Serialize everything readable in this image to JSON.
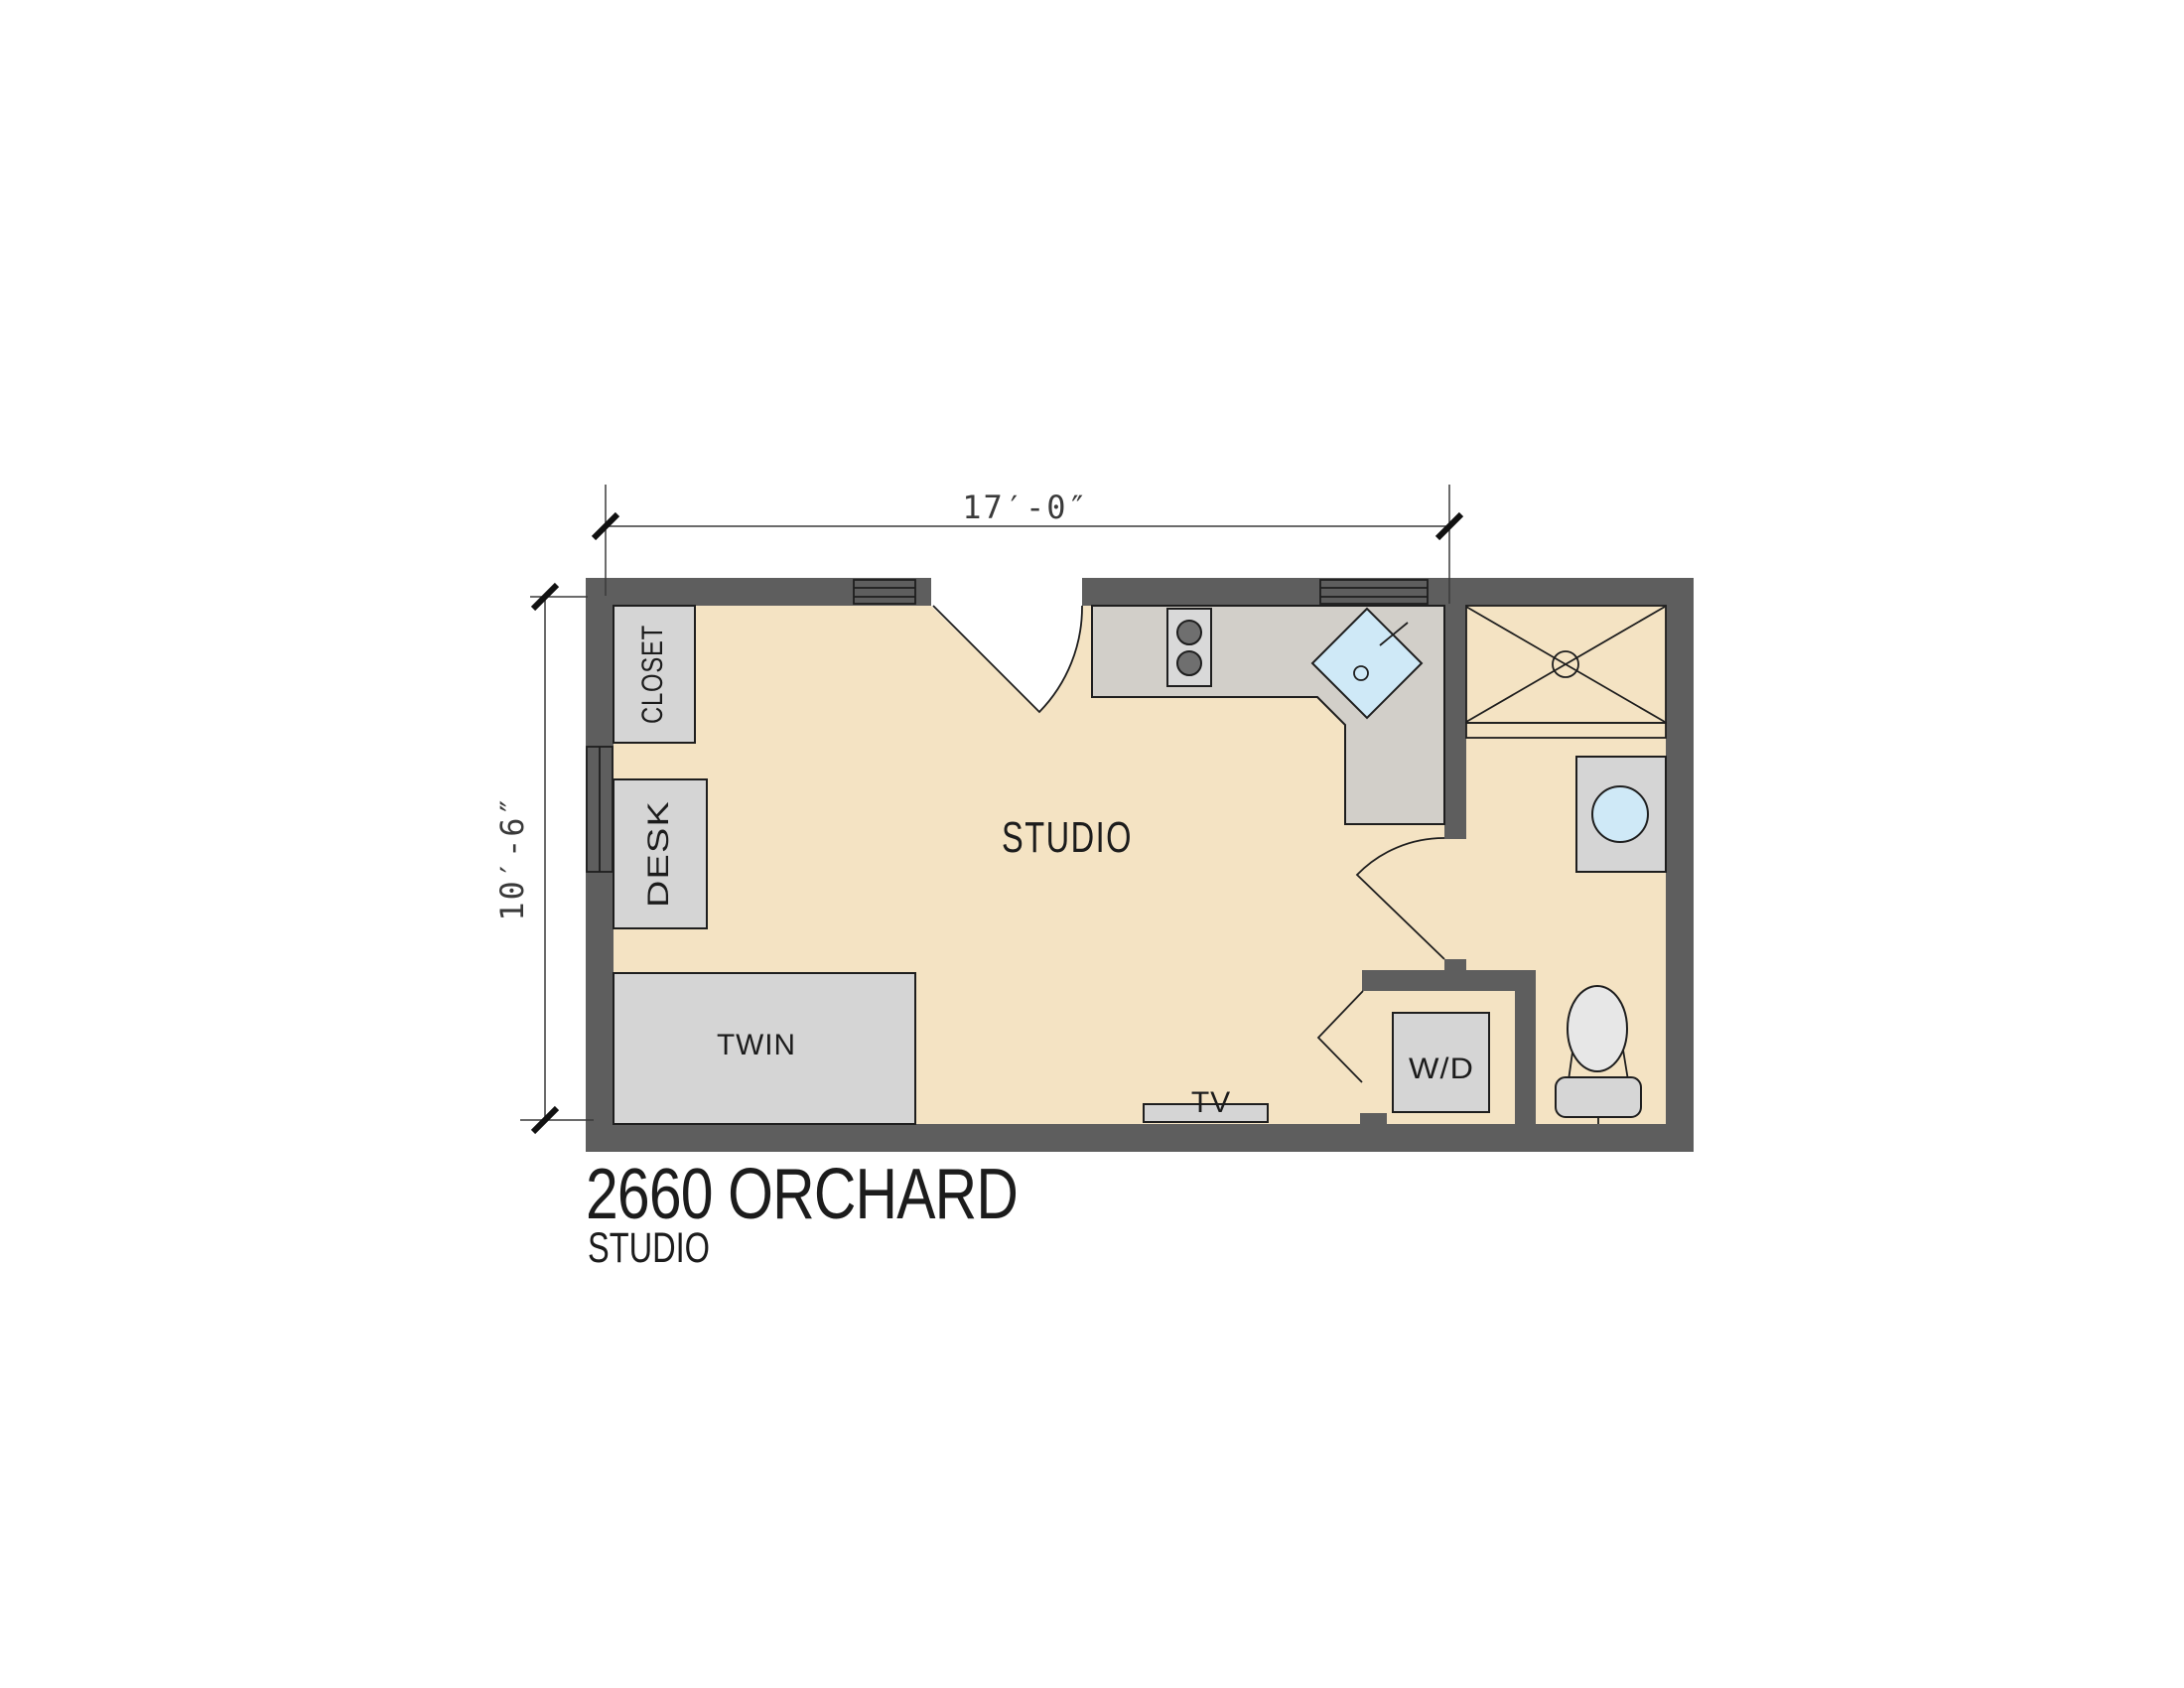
{
  "plan": {
    "title": "2660 ORCHARD",
    "subtitle": "STUDIO",
    "room_label": "STUDIO",
    "dimensions": {
      "width": "17′-0″",
      "height": "10′-6″"
    },
    "labels": {
      "closet": "CLOSET",
      "desk": "DESK",
      "bed": "TWIN",
      "tv": "TV",
      "washer_dryer": "W/D"
    },
    "colors": {
      "wall": "#5e5e5e",
      "floor": "#f4e3c3",
      "furniture": "#d5d5d5",
      "counter": "#d2cfc9",
      "water": "#cfe9f7",
      "shower_floor": "#ececec",
      "window": "#f5f5f5"
    }
  }
}
